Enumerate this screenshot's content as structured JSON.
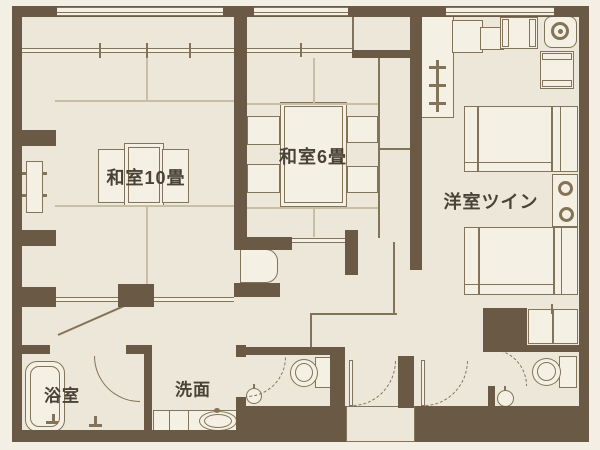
{
  "plan_type": "floor-plan",
  "rooms": {
    "washitsu10": {
      "label": "和室10畳"
    },
    "washitsu6": {
      "label": "和室6畳"
    },
    "twin": {
      "label": "洋室ツイン"
    },
    "bath": {
      "label": "浴室"
    },
    "washroom": {
      "label": "洗面"
    }
  },
  "fixtures": {
    "washitsu10": [
      "low-table",
      "floor-chair",
      "floor-chair",
      "closet",
      "chest"
    ],
    "washitsu6": [
      "low-table",
      "floor-chair",
      "floor-chair",
      "floor-chair",
      "floor-chair",
      "closet"
    ],
    "twin": [
      "bed",
      "bed",
      "nightstand",
      "lamp",
      "lamp",
      "round-table",
      "armchair",
      "armchair",
      "desk",
      "luggage-rack",
      "closet"
    ],
    "bath": [
      "bathtub",
      "shower-mixer"
    ],
    "washroom": [
      "vanity-counter",
      "washbasin"
    ],
    "toilets": [
      "toilet",
      "hand-basin",
      "toilet",
      "hand-basin"
    ]
  },
  "colors": {
    "wall": "#6a5a45",
    "floor": "#ece7d9",
    "furniture": "#f4f0e4",
    "background": "#f3efe5",
    "line": "#837358",
    "tatami_line": "#c9bda6",
    "text": "#4b4237"
  }
}
